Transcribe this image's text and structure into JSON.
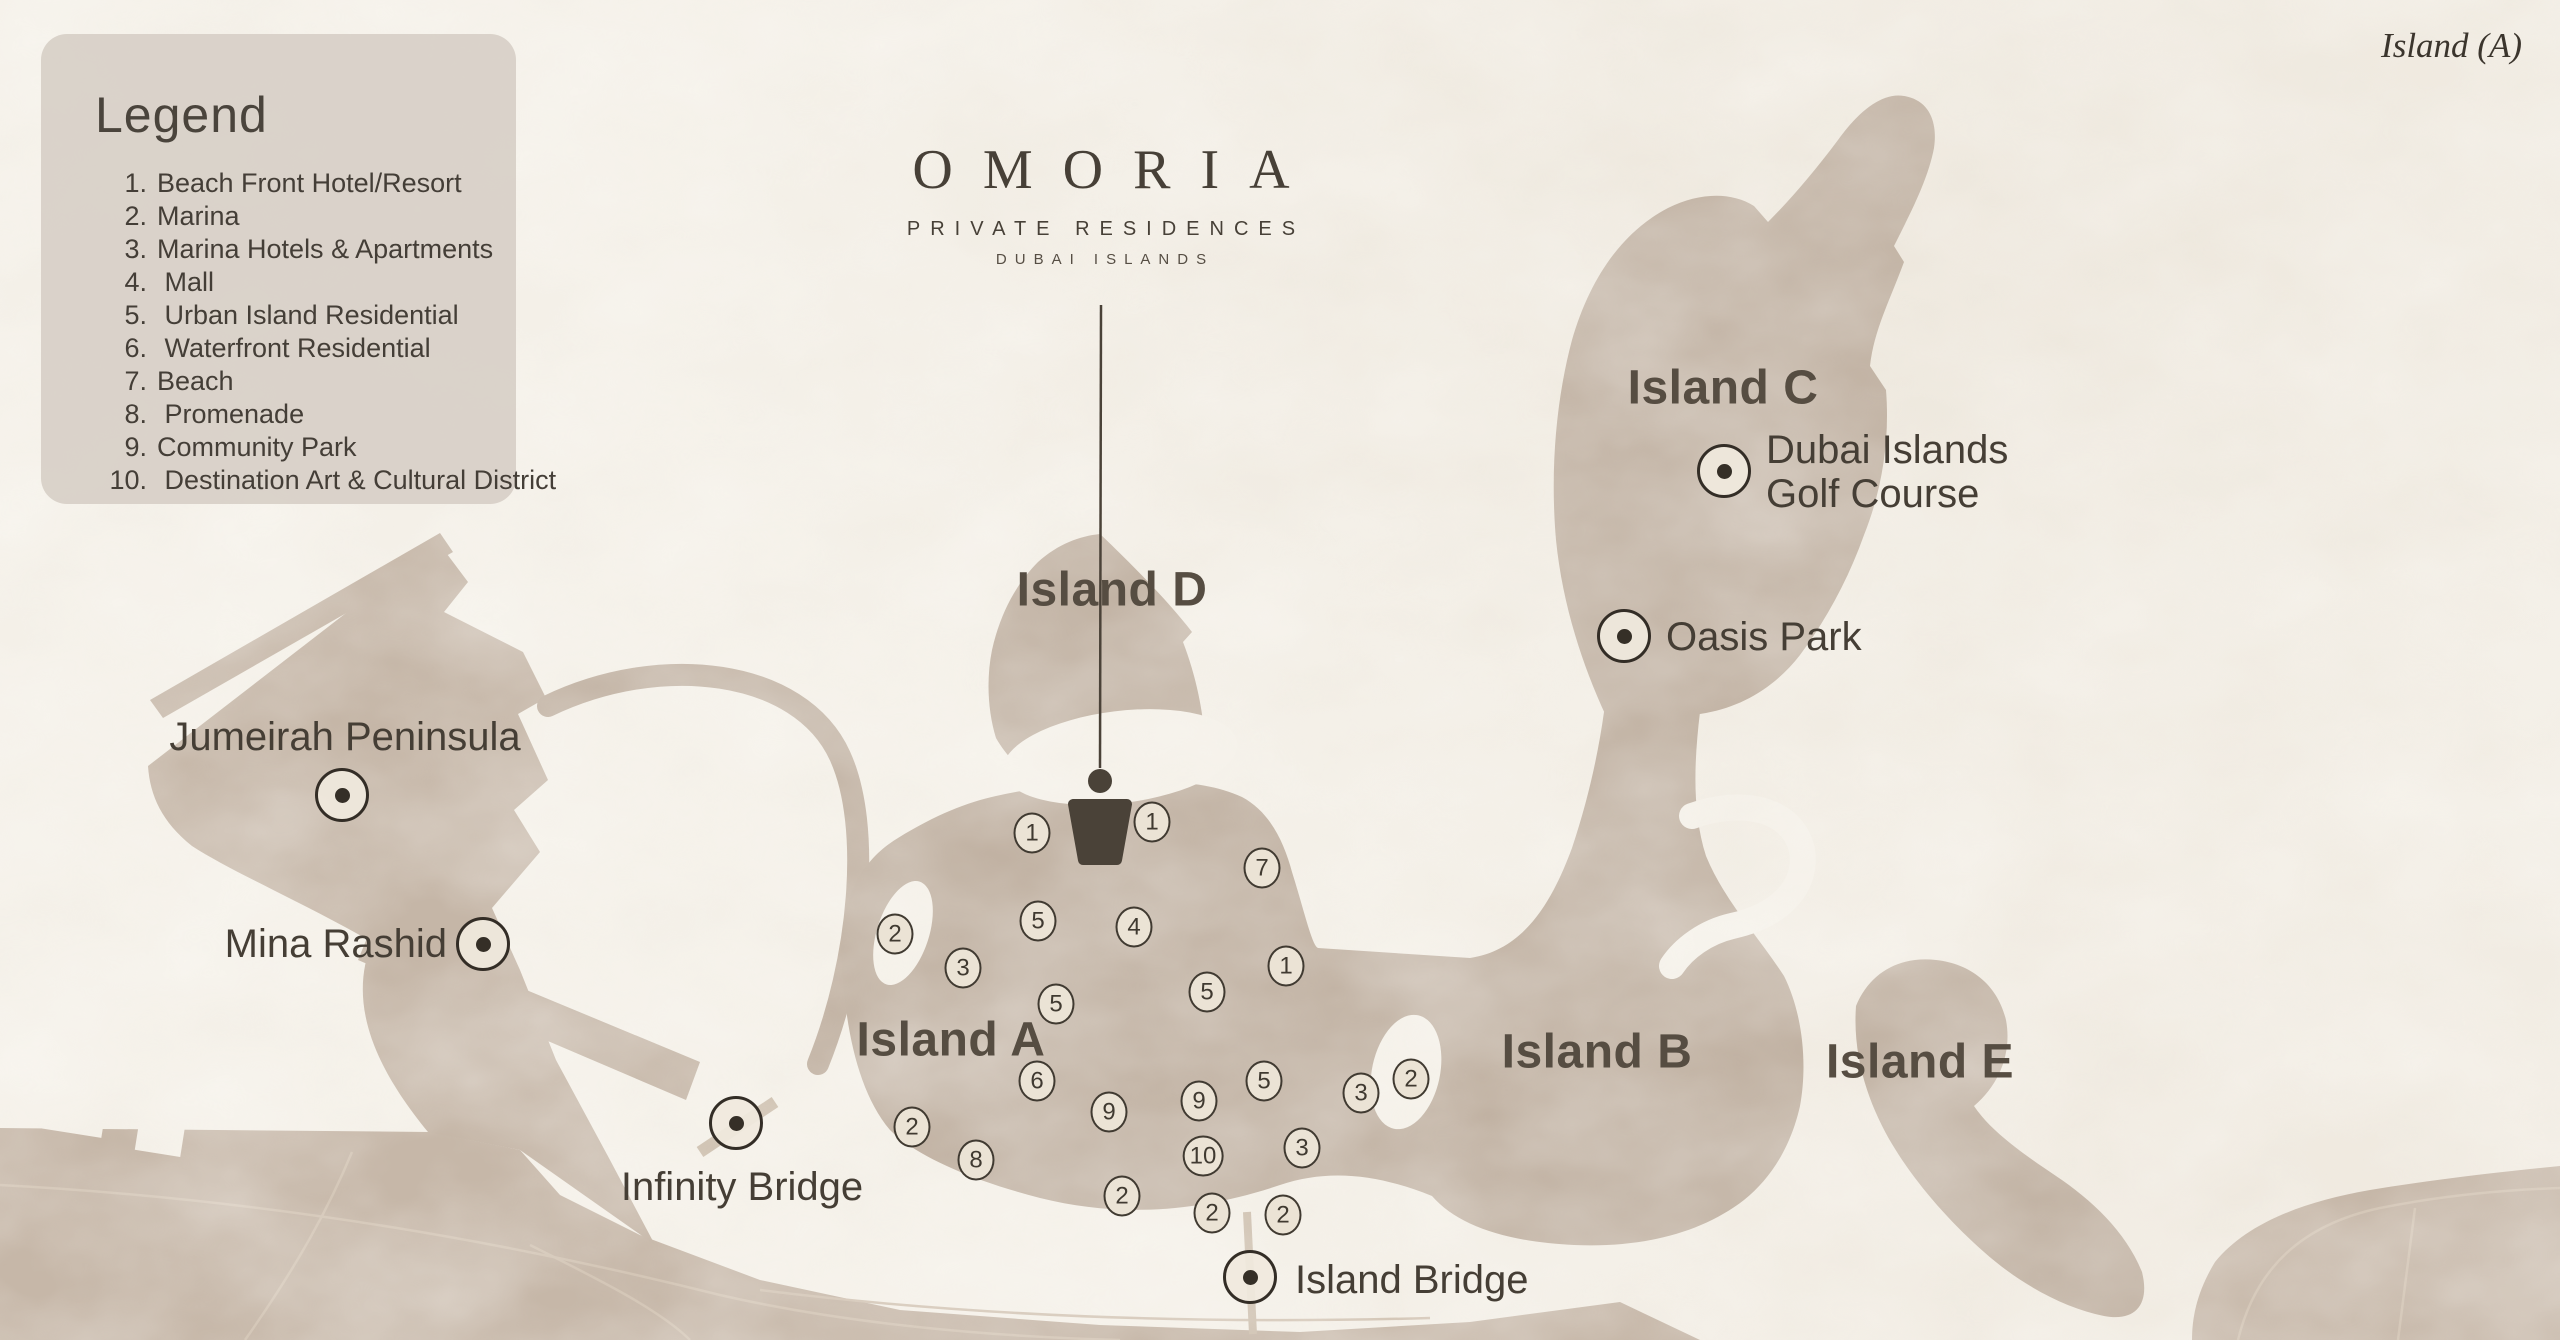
{
  "corner_note": "Island (A)",
  "legend": {
    "title": "Legend",
    "items": [
      {
        "num": "1.",
        "label": "Beach Front Hotel/Resort"
      },
      {
        "num": "2.",
        "label": "Marina"
      },
      {
        "num": "3.",
        "label": "Marina Hotels & Apartments"
      },
      {
        "num": "4.",
        "label": " Mall"
      },
      {
        "num": "5.",
        "label": " Urban Island Residential"
      },
      {
        "num": "6.",
        "label": " Waterfront Residential"
      },
      {
        "num": "7.",
        "label": "Beach"
      },
      {
        "num": "8.",
        "label": " Promenade"
      },
      {
        "num": "9.",
        "label": "Community Park"
      },
      {
        "num": "10.",
        "label": " Destination Art & Cultural District"
      }
    ]
  },
  "logo": {
    "name": "OMORIA",
    "subtitle": "PRIVATE RESIDENCES",
    "location": "DUBAI ISLANDS"
  },
  "island_labels": [
    {
      "id": "island-a",
      "label": "Island A",
      "x": 951,
      "y": 1040
    },
    {
      "id": "island-b",
      "label": "Island B",
      "x": 1597,
      "y": 1052
    },
    {
      "id": "island-c",
      "label": "Island C",
      "x": 1723,
      "y": 388
    },
    {
      "id": "island-d",
      "label": "Island D",
      "x": 1112,
      "y": 590
    },
    {
      "id": "island-e",
      "label": "Island E",
      "x": 1920,
      "y": 1062
    }
  ],
  "pois": [
    {
      "id": "jumeirah-peninsula",
      "label": "Jumeirah Peninsula",
      "mx": 342,
      "my": 795,
      "lx": 345,
      "ly": 737,
      "anchor": "center"
    },
    {
      "id": "mina-rashid",
      "label": "Mina Rashid",
      "mx": 483,
      "my": 944,
      "lx": 447,
      "ly": 944,
      "anchor": "end"
    },
    {
      "id": "infinity-bridge",
      "label": "Infinity Bridge",
      "mx": 736,
      "my": 1123,
      "lx": 742,
      "ly": 1187,
      "anchor": "center"
    },
    {
      "id": "island-bridge",
      "label": "Island Bridge",
      "mx": 1250,
      "my": 1277,
      "lx": 1295,
      "ly": 1280,
      "anchor": "start"
    },
    {
      "id": "dubai-islands-golf-course",
      "label": "Dubai Islands\nGolf Course",
      "mx": 1724,
      "my": 471,
      "lx": 1766,
      "ly": 472,
      "anchor": "start"
    },
    {
      "id": "oasis-park",
      "label": "Oasis Park",
      "mx": 1624,
      "my": 636,
      "lx": 1666,
      "ly": 637,
      "anchor": "start"
    }
  ],
  "badges": [
    {
      "n": "1",
      "x": 1032,
      "y": 833
    },
    {
      "n": "1",
      "x": 1152,
      "y": 822
    },
    {
      "n": "7",
      "x": 1262,
      "y": 868
    },
    {
      "n": "2",
      "x": 895,
      "y": 934
    },
    {
      "n": "5",
      "x": 1038,
      "y": 921
    },
    {
      "n": "4",
      "x": 1134,
      "y": 927
    },
    {
      "n": "3",
      "x": 963,
      "y": 968
    },
    {
      "n": "1",
      "x": 1286,
      "y": 966
    },
    {
      "n": "5",
      "x": 1056,
      "y": 1004
    },
    {
      "n": "5",
      "x": 1207,
      "y": 992
    },
    {
      "n": "6",
      "x": 1037,
      "y": 1081
    },
    {
      "n": "9",
      "x": 1109,
      "y": 1112
    },
    {
      "n": "9",
      "x": 1199,
      "y": 1101
    },
    {
      "n": "5",
      "x": 1264,
      "y": 1081
    },
    {
      "n": "3",
      "x": 1361,
      "y": 1093
    },
    {
      "n": "2",
      "x": 1411,
      "y": 1079
    },
    {
      "n": "2",
      "x": 912,
      "y": 1127
    },
    {
      "n": "8",
      "x": 976,
      "y": 1160
    },
    {
      "n": "10",
      "x": 1203,
      "y": 1156
    },
    {
      "n": "3",
      "x": 1302,
      "y": 1148
    },
    {
      "n": "2",
      "x": 1122,
      "y": 1196
    },
    {
      "n": "2",
      "x": 1212,
      "y": 1213
    },
    {
      "n": "2",
      "x": 1283,
      "y": 1215
    }
  ],
  "colors": {
    "water": "#f4f0e8",
    "island_land": "#c1b2a3",
    "mainland_land": "#c6b7a8",
    "dark_ink": "#4a4339",
    "site_marker": "#4a4238",
    "badge_fill": "#ebe3d5",
    "legend_panel": "#d7d0c7",
    "road": "#d2c4b4"
  }
}
